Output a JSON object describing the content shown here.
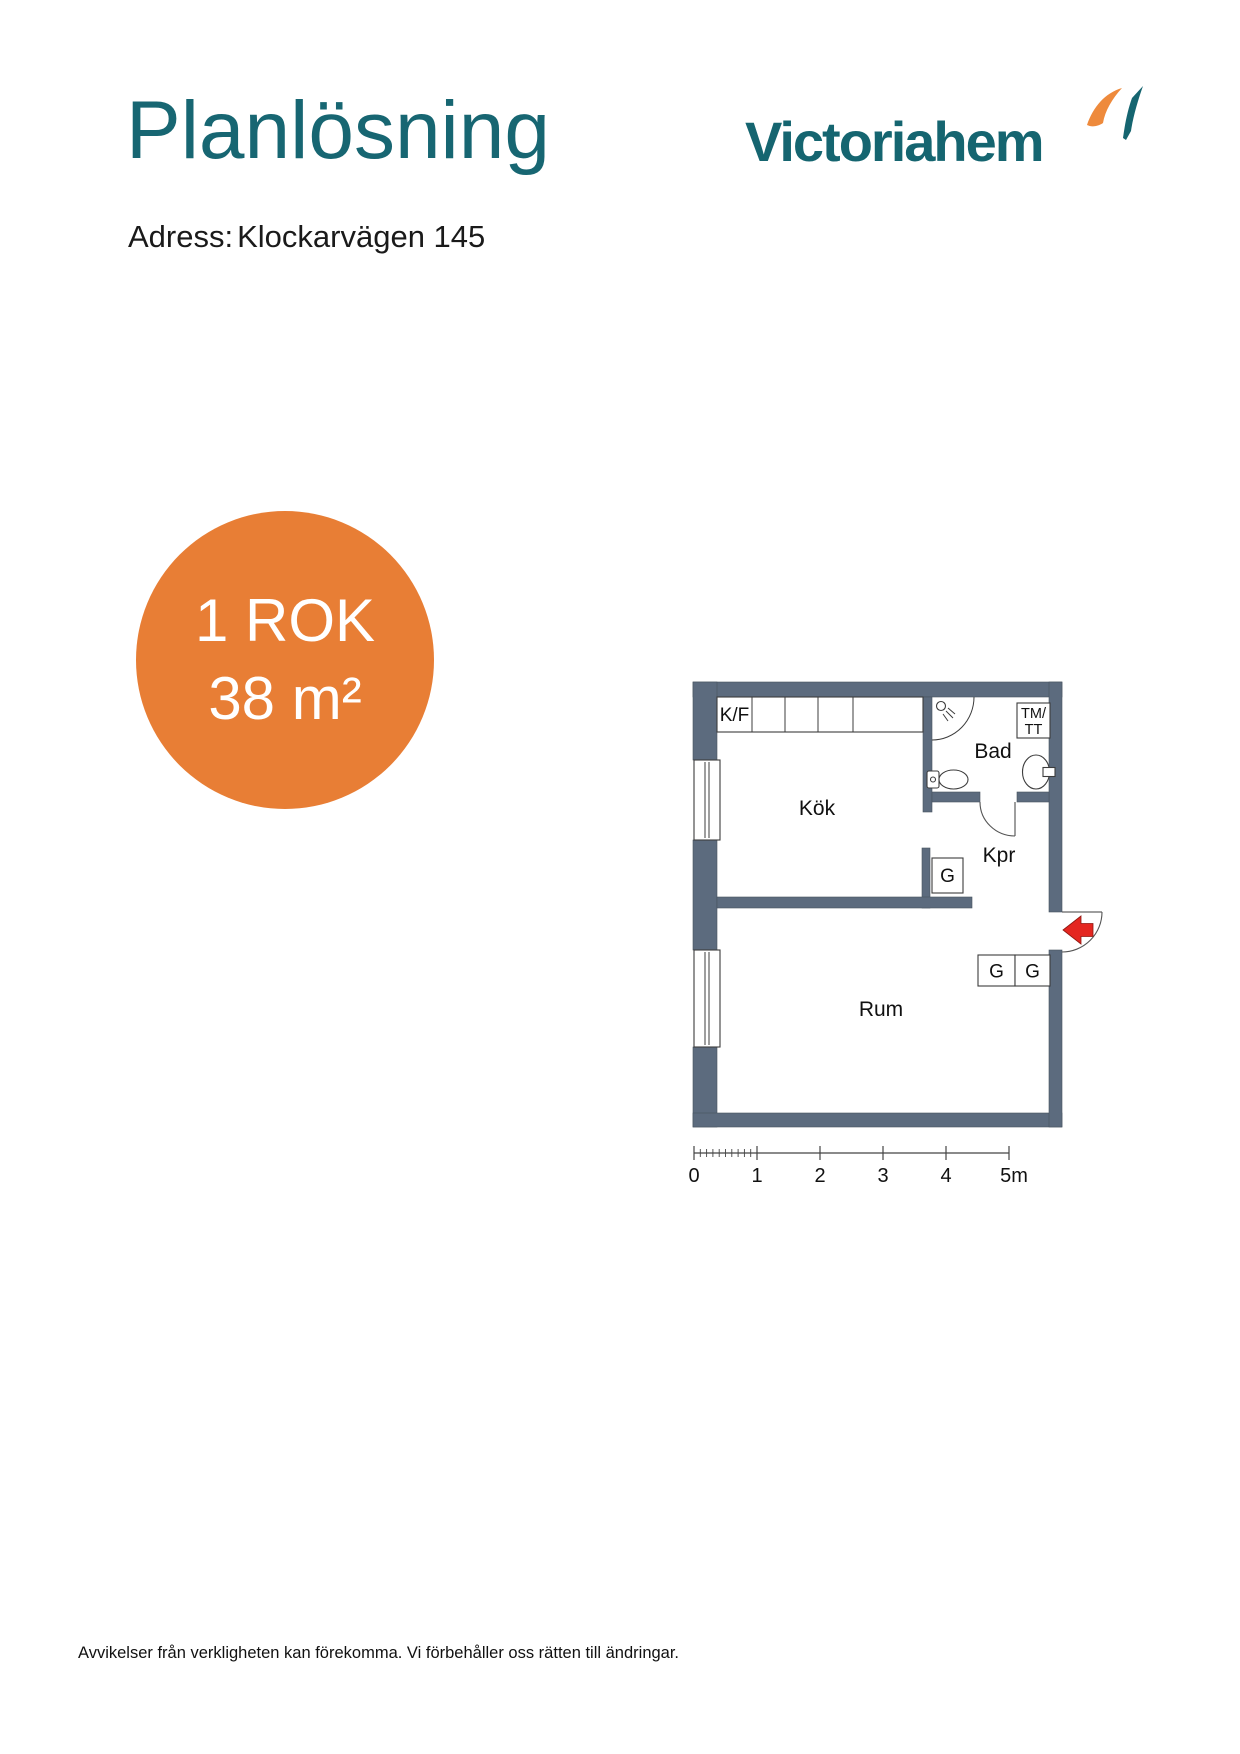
{
  "header": {
    "title": "Planlösning",
    "address_label": "Adress:",
    "address_value": "Klockarvägen 145",
    "brand": {
      "name": "Victoriahem",
      "teal": "#156570",
      "orange": "#ee8a3c"
    }
  },
  "area_badge": {
    "rooms": "1 ROK",
    "area": "38 m²",
    "bg_color": "#e87e35",
    "text_color": "#ffffff"
  },
  "floor_plan": {
    "wall_color": "#5c6b7e",
    "entry_arrow_color": "#e42620",
    "labels": {
      "kitchen": "Kök",
      "bathroom": "Bad",
      "hall": "Kpr",
      "room": "Rum",
      "fridge_freezer": "K/F",
      "washer_dryer_line1": "TM/",
      "washer_dryer_line2": "TT",
      "wardrobe_1": "G",
      "wardrobe_2": "G",
      "wardrobe_3": "G"
    }
  },
  "scale_bar": {
    "labels": [
      "0",
      "1",
      "2",
      "3",
      "4",
      "5m"
    ]
  },
  "footer": {
    "disclaimer": "Avvikelser från verkligheten kan förekomma. Vi förbehåller oss rätten till ändringar."
  }
}
